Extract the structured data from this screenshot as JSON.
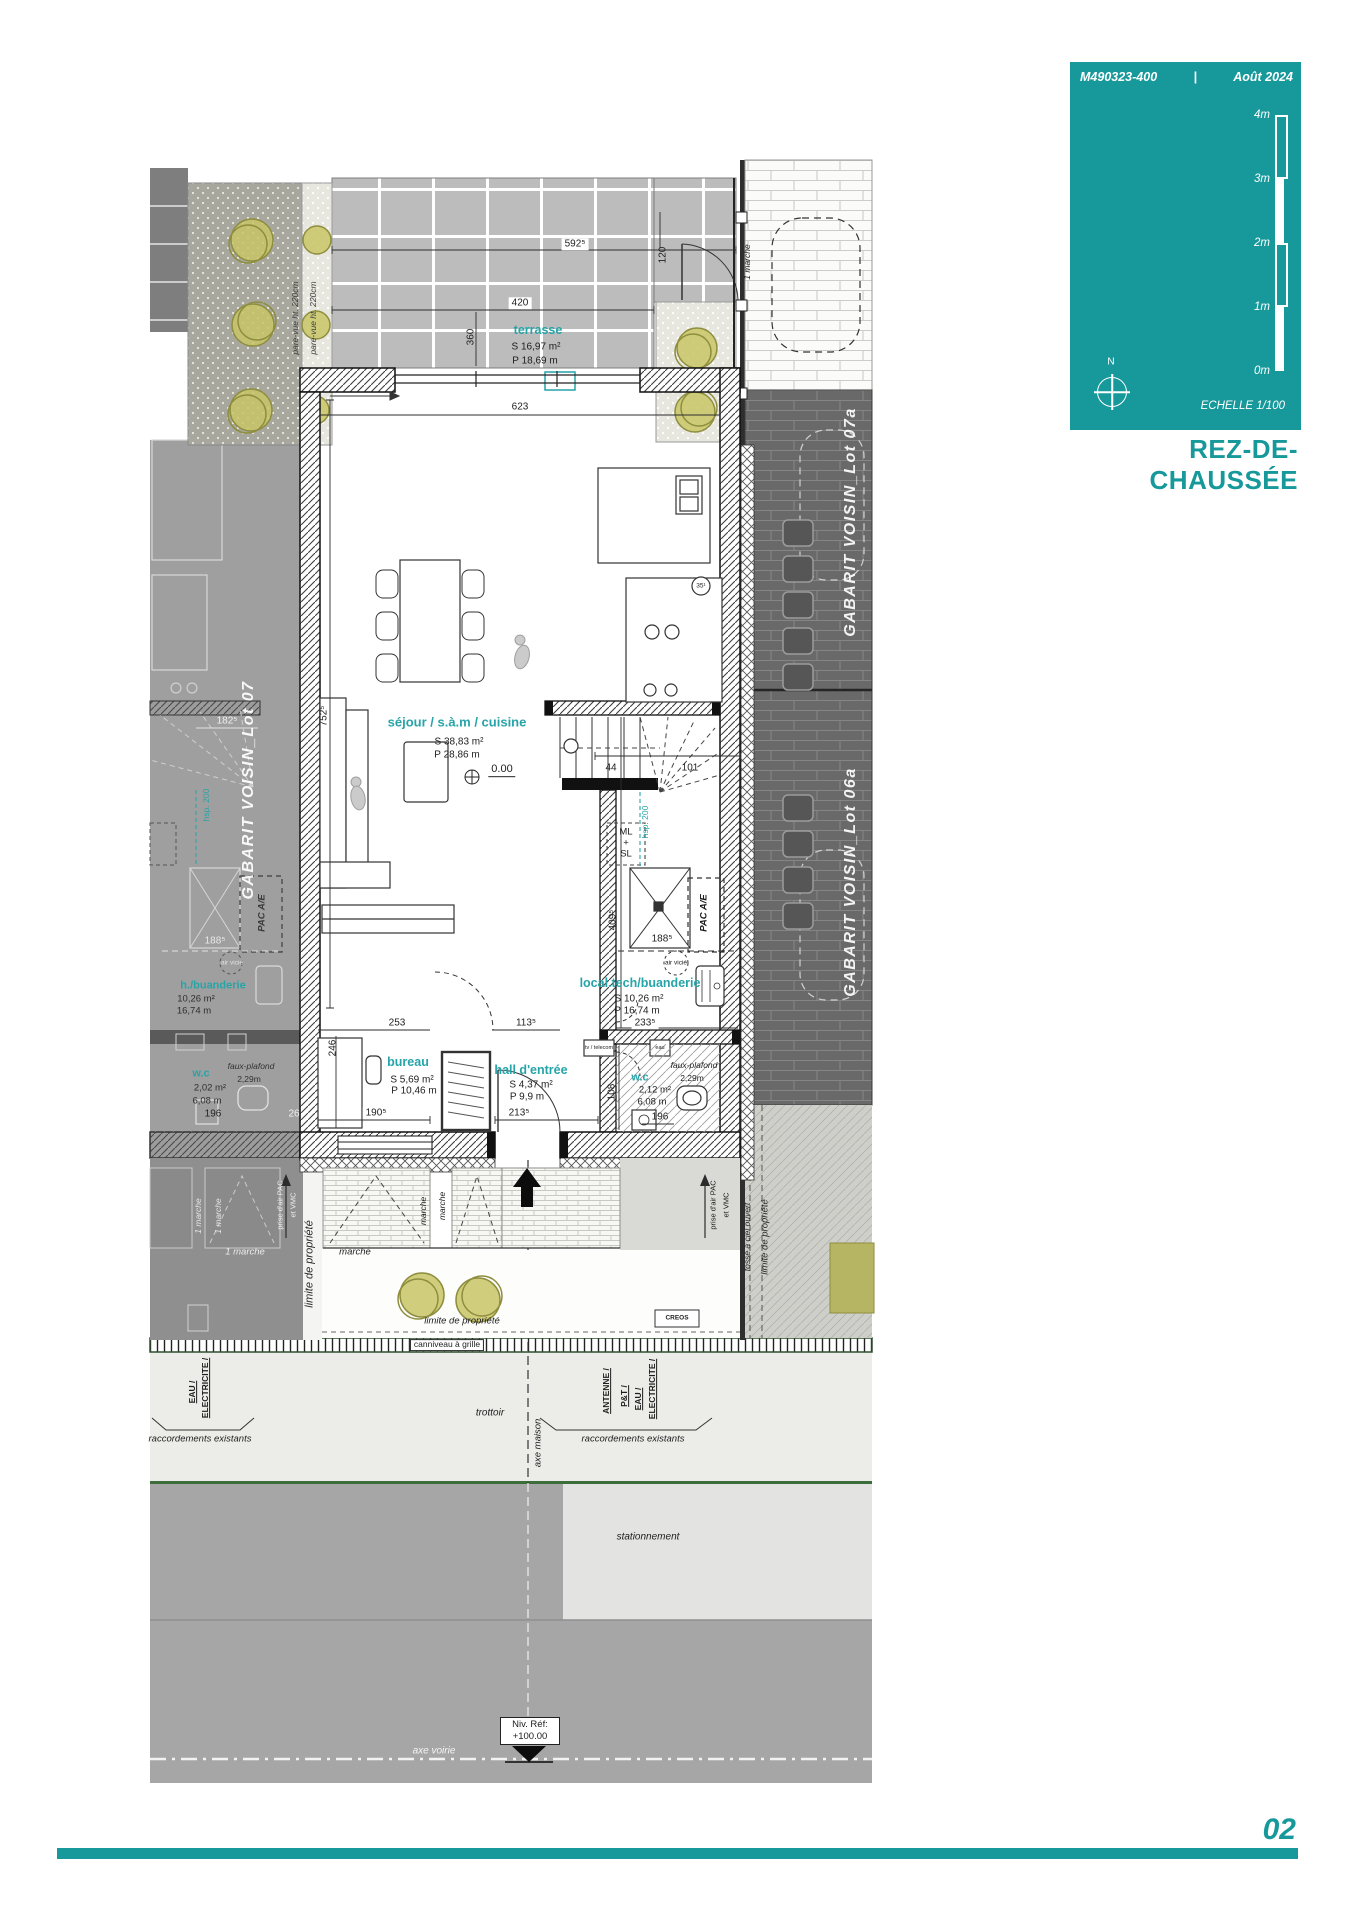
{
  "header": {
    "ref": "M490323-400",
    "sep": "|",
    "date": "Août 2024",
    "marks": [
      "4m",
      "3m",
      "2m",
      "1m",
      "0m"
    ],
    "north": "N",
    "echelle": "ECHELLE  1/100"
  },
  "title": "REZ-DE-CHAUSSÉE",
  "page": "02",
  "colors": {
    "accent": "#17989a",
    "room_label": "#27a4a8",
    "plant": "#c8c566"
  },
  "rooms": {
    "terrasse": {
      "name": "terrasse",
      "s": "S  16,97 m²",
      "p": "P  18,69 m"
    },
    "sejour": {
      "name": "séjour / s.à.m / cuisine",
      "s": "S  38,83 m²",
      "p": "P  28,86 m"
    },
    "bureau": {
      "name": "bureau",
      "s": "S  5,69 m²",
      "p": "P  10,46 m"
    },
    "hall": {
      "name": "hall d'entrée",
      "s": "S  4,37 m²",
      "p": "P  9,9 m"
    },
    "local_tech": {
      "name": "local.tech/buanderie",
      "s": "S  10,26 m²",
      "p": "P  16,74 m"
    },
    "wc": {
      "name": "w.c",
      "s": "2,12 m²",
      "p": "6,08 m"
    },
    "wc_left": {
      "name": "w.c",
      "s": "2,02 m²",
      "p": "6,08 m"
    },
    "buanderie_left": {
      "name": "h./buanderie",
      "s": "10,26 m²",
      "p": "16,74 m"
    }
  },
  "level": {
    "zero": "0.00"
  },
  "dims": {
    "d592": "592⁵",
    "d120": "120",
    "d420": "420",
    "d360": "360",
    "d623": "623",
    "d752": "752⁵",
    "d44": "44",
    "d101": "101",
    "d409": "409⁵",
    "d188": "188⁵",
    "d233": "233⁵",
    "d253": "253",
    "d246": "246",
    "d190": "190⁵",
    "d213": "213⁵",
    "d113": "113⁵",
    "d108": "108",
    "d196": "196",
    "d182": "182⁵",
    "d26": "26",
    "d35": "35¹"
  },
  "ann": {
    "ml": "ML",
    "plus": "+",
    "sl": "SL",
    "pac": "PAC A/E",
    "hsp": "hsp. 200",
    "air": "air vicié",
    "faux": "faux-plafond",
    "faux_h": "2,29m",
    "marche1": "1 marche",
    "marche": "marche",
    "pare_vue": "pare-vue ht. 220cm",
    "prise1": "prise d'air PAC",
    "prise2": "et VMC",
    "tv": "tv / telecom",
    "eau": "eau",
    "creos": "CREOS"
  },
  "neighbors": {
    "lot07": "GABARIT VOISIN_Lot 07",
    "lot07a": "GABARIT VOISIN_Lot 07a",
    "lot06a": "GABARIT VOISIN_Lot 06a"
  },
  "site": {
    "canniveau": "canniveau à grille",
    "trottoir": "trottoir",
    "stationnement": "stationnement",
    "axe_maison": "axe maison",
    "axe_voirie": "axe voirie",
    "limite": "limite de propriété",
    "fosse": "fossé à ciel ouvert",
    "racc": "raccordements existants",
    "util_left": [
      "EAU /",
      "ELECTRICITE /"
    ],
    "util_right": [
      "ANTENNE /",
      "P&T /",
      "EAU /",
      "ELECTRICITE /"
    ],
    "niv_label": "Niv. Réf:",
    "niv_value": "+100.00"
  }
}
